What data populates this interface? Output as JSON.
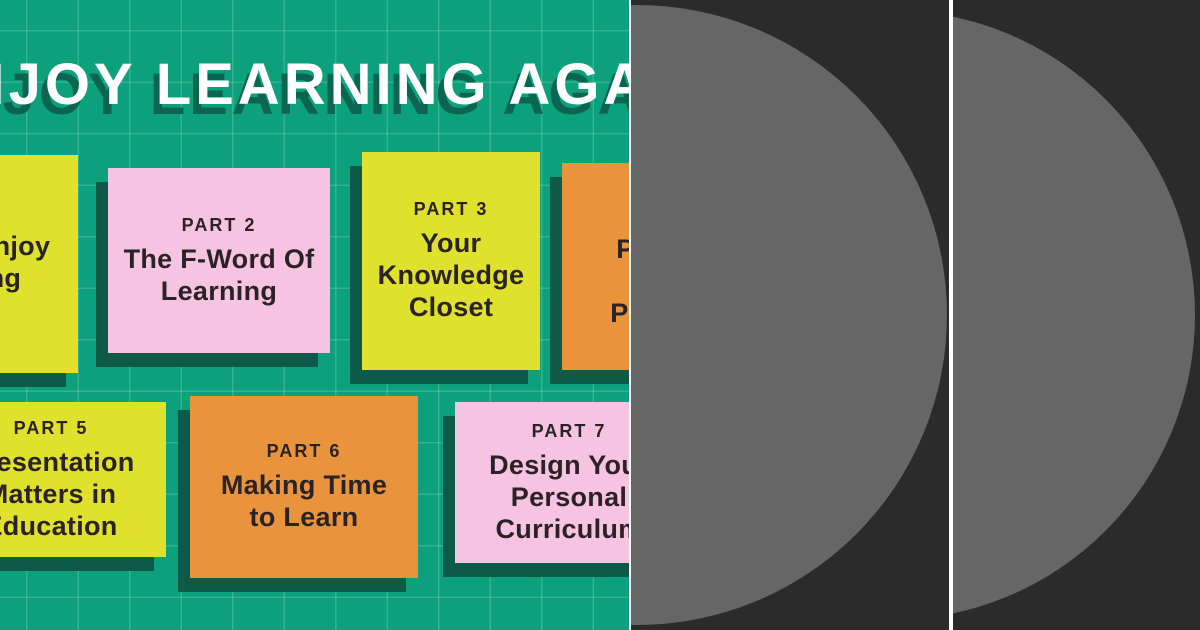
{
  "canvas": {
    "width": 1200,
    "height": 630
  },
  "colors": {
    "background_green": "#0ca17c",
    "grid_line": "rgba(255,255,255,0.17)",
    "card_yellow": "#dfe12d",
    "card_pink": "#f7c3e2",
    "card_orange": "#e9943d",
    "card_shadow": "#0e5a48",
    "card_text": "#2a2224",
    "title_white": "#ffffff",
    "title_shadow": "#0c6550",
    "dark_panel": "#2b2b2b",
    "circle_gray": "#666666",
    "divider_white": "#ffffff"
  },
  "infographic": {
    "title": {
      "full_text": "ENJOY LEARNING AGAIN",
      "visible_text": "JOY LEARNING AGA"
    },
    "cards": [
      {
        "id": "part-1",
        "color": "yellow",
        "label": "PART 1",
        "title_lines": [
          "How to Enjoy",
          "Learning",
          "Again"
        ],
        "visible_fragments": [
          "1",
          "Enjoy",
          "ng",
          "n"
        ]
      },
      {
        "id": "part-2",
        "color": "pink",
        "label": "PART 2",
        "title_lines": [
          "The F-Word Of",
          "Learning"
        ]
      },
      {
        "id": "part-3",
        "color": "yellow",
        "label": "PART 3",
        "title_lines": [
          "Your",
          "Knowledge",
          "Closet"
        ]
      },
      {
        "id": "part-4",
        "color": "orange",
        "label": "PART 4",
        "title_lines": [
          "Practice",
          "Makes",
          "Progress"
        ],
        "visible_fragments": [
          "P",
          "Pr",
          "M",
          "Pr"
        ]
      },
      {
        "id": "part-5",
        "color": "yellow",
        "label": "PART 5",
        "title_lines": [
          "Presentation",
          "Matters in",
          "Education"
        ],
        "visible_fragments": [
          "PART 5",
          "esentation",
          "atters in",
          "ucation"
        ]
      },
      {
        "id": "part-6",
        "color": "orange",
        "label": "PART 6",
        "title_lines": [
          "Making Time",
          "to Learn"
        ]
      },
      {
        "id": "part-7",
        "color": "pink",
        "label": "PART 7",
        "title_lines": [
          "Design Your",
          "Personal",
          "Curriculum"
        ],
        "visible_fragments": [
          "PART 7",
          "Design Yo",
          "Persona",
          "Curriculu"
        ]
      }
    ]
  },
  "right_panels": {
    "count": 2,
    "description": "dark panels each containing a large clipped gray circle"
  }
}
